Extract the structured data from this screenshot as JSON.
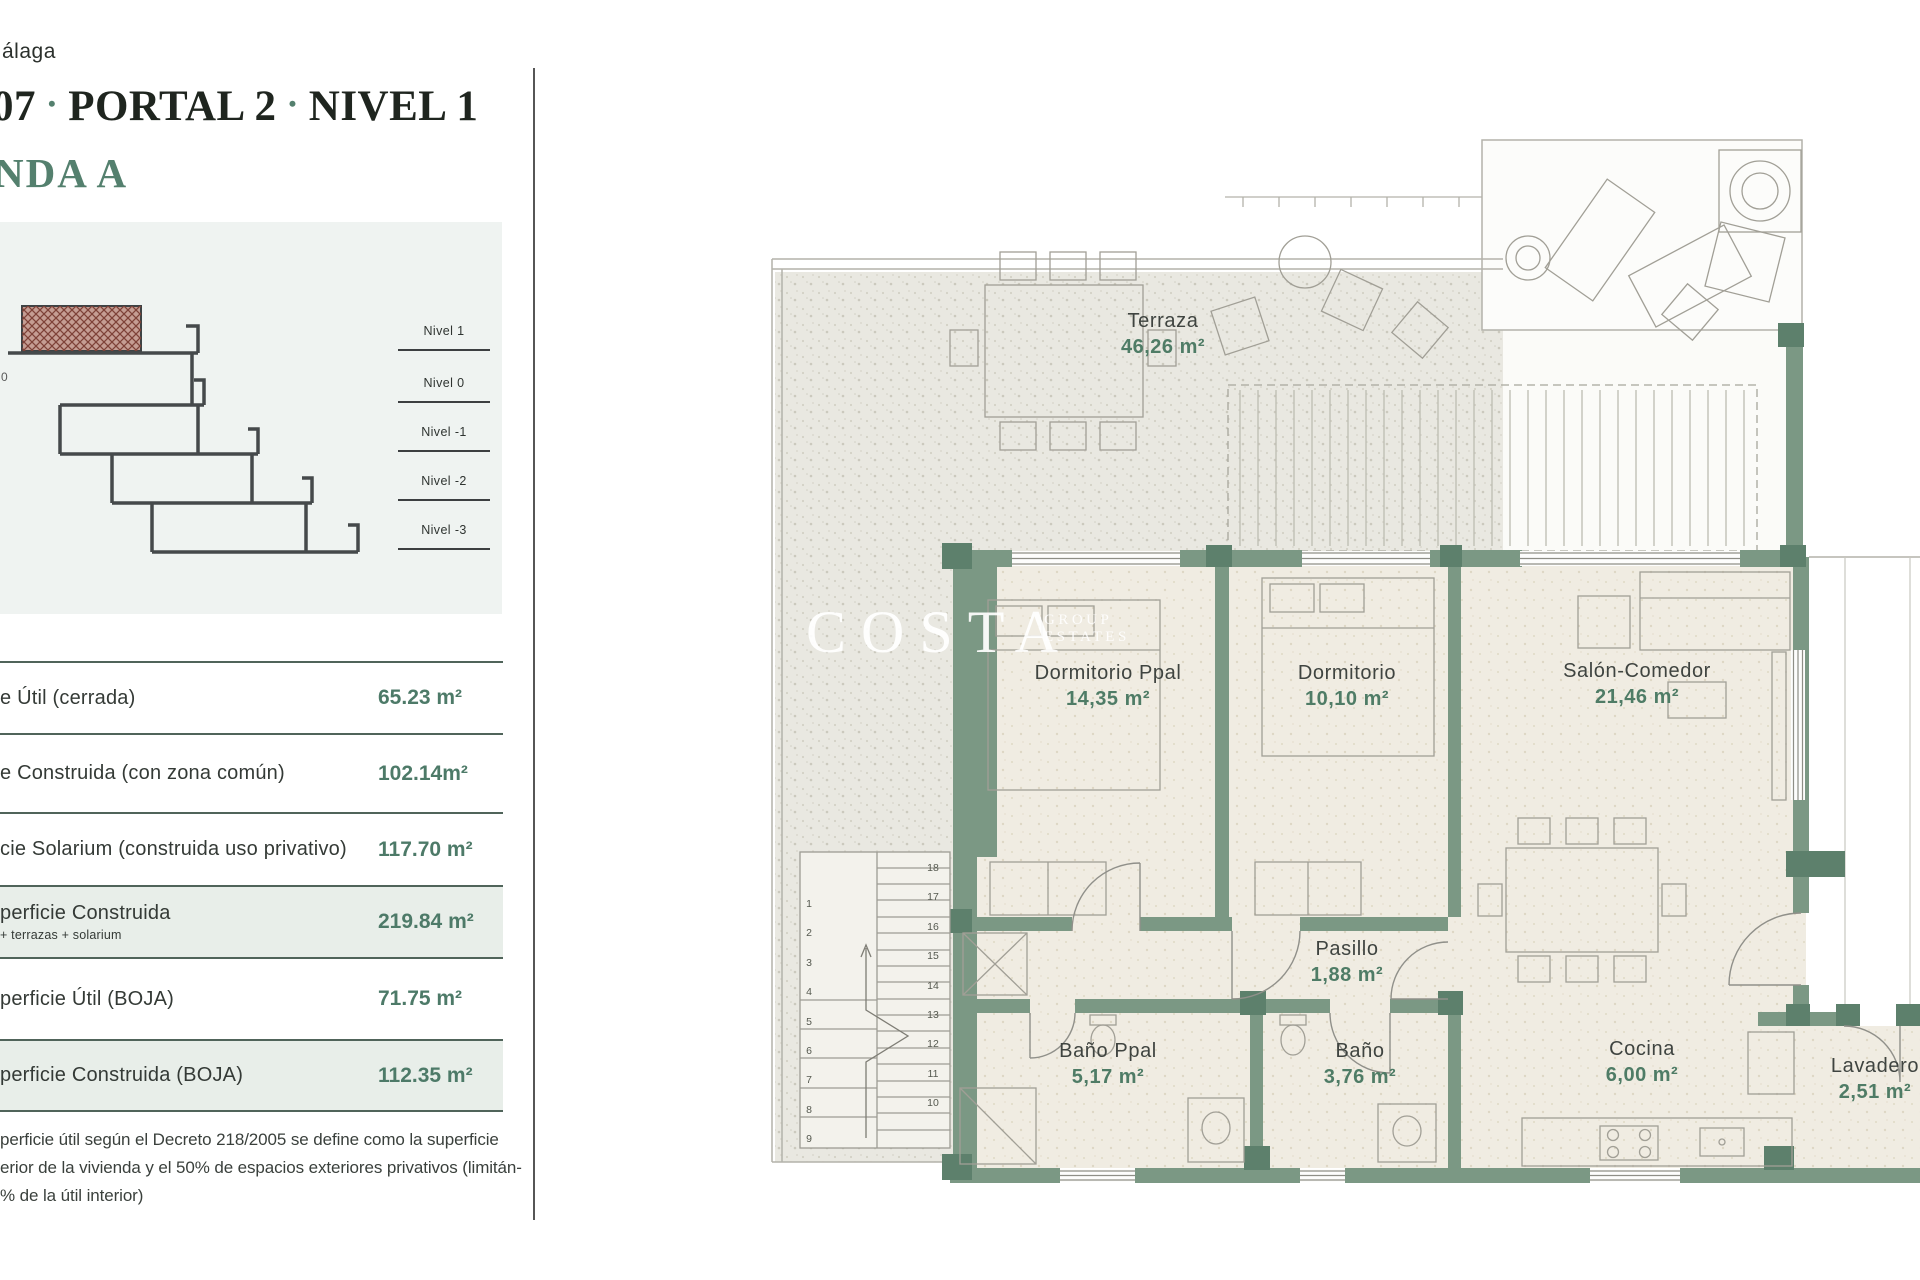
{
  "header": {
    "location": "álaga",
    "title": {
      "num": "07",
      "sep": "•",
      "mid": "PORTAL 2",
      "end": "NIVEL 1"
    },
    "unit": "NDA A"
  },
  "section": {
    "zero_label": "0",
    "levels": [
      "Nivel 1",
      "Nivel 0",
      "Nivel -1",
      "Nivel -2",
      "Nivel -3"
    ]
  },
  "areas_table": {
    "rows": [
      {
        "label": "e Útil (cerrada)",
        "value": "65.23 m²"
      },
      {
        "label": "e Construida (con zona común)",
        "value": "102.14m²"
      },
      {
        "label": "cie Solarium (construida uso privativo)",
        "value": "117.70 m²"
      },
      {
        "label": "perficie Construida",
        "sublabel": "+ terrazas + solarium",
        "value": "219.84 m²"
      },
      {
        "label": "perficie Útil (BOJA)",
        "value": "71.75 m²"
      },
      {
        "label": "perficie Construida (BOJA)",
        "value": "112.35 m²"
      }
    ]
  },
  "footnote": {
    "line1": "perficie útil según el Decreto 218/2005 se define como la superficie",
    "line2": "erior de la vivienda y el 50% de espacios exteriores privativos (limitán-",
    "line3": "% de la útil interior)"
  },
  "floor_plan": {
    "watermark": {
      "main": "COSTA",
      "sub_top": "GROUP",
      "sub_bottom": "ESTATES"
    },
    "rooms": [
      {
        "name": "Terraza",
        "area": "46,26 m²"
      },
      {
        "name": "Dormitorio Ppal",
        "area": "14,35 m²"
      },
      {
        "name": "Dormitorio",
        "area": "10,10 m²"
      },
      {
        "name": "Salón-Comedor",
        "area": "21,46 m²"
      },
      {
        "name": "Pasillo",
        "area": "1,88 m²"
      },
      {
        "name": "Baño Ppal",
        "area": "5,17 m²"
      },
      {
        "name": "Baño",
        "area": "3,76 m²"
      },
      {
        "name": "Cocina",
        "area": "6,00 m²"
      },
      {
        "name": "Lavadero",
        "area": "2,51 m²"
      }
    ],
    "stairs": {
      "left": [
        "1",
        "2",
        "3",
        "4",
        "5",
        "6",
        "7",
        "8",
        "9"
      ],
      "right": [
        "18",
        "17",
        "16",
        "15",
        "14",
        "13",
        "12",
        "11",
        "10"
      ]
    }
  },
  "colors": {
    "accent_green": "#4d7a68",
    "wall_green": "#7b9884",
    "row_highlight": "#e8eee9"
  }
}
